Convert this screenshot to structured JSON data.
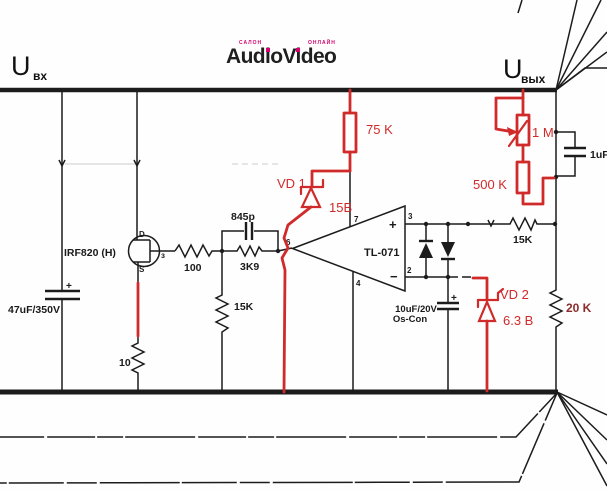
{
  "page": {
    "background": "#fefefe"
  },
  "colors": {
    "ink": "#1c1c1c",
    "annotation_red": "#d12a2a",
    "dark_red_label": "#8b2b2b",
    "logo_magenta": "#d6006e"
  },
  "header": {
    "input_label": {
      "base": "U",
      "sub": "вх"
    },
    "output_label": {
      "base": "U",
      "sub": "вых"
    },
    "logo": {
      "top_left": "салон",
      "main": "AudioVideo",
      "top_right": "онлайн"
    }
  },
  "components": {
    "input_cap": {
      "label": "47uF/350V",
      "plus": "+"
    },
    "mosfet": {
      "label": "IRF820 (H)",
      "pin_drain": "D",
      "pin_source": "S",
      "pin_gate": "з"
    },
    "gate_resistor": {
      "label": "100"
    },
    "feedback_cap": {
      "label": "845p"
    },
    "feedback_resistor": {
      "label": "3K9"
    },
    "gate_gnd_resistor": {
      "label": "15K"
    },
    "source_resistor": {
      "label": "10"
    },
    "opamp": {
      "label": "TL-071",
      "pin7": "7",
      "pin4": "4",
      "pin3": "3",
      "pin2": "2",
      "pin6": "6",
      "plus": "+",
      "minus": "−"
    },
    "supply_resistor": {
      "label": "75 K"
    },
    "zener1": {
      "designator": "VD 1",
      "value": "15B"
    },
    "pot": {
      "label": "1 M"
    },
    "divider_resistor": {
      "label": "500 K"
    },
    "output_cap": {
      "label": "1uF"
    },
    "sense_resistor": {
      "label": "15K"
    },
    "load_resistor": {
      "label": "20 K"
    },
    "oscon_cap": {
      "line1": "10uF/20V",
      "line2": "Os-Con",
      "plus": "+"
    },
    "zener2": {
      "designator": "VD 2",
      "value": "6.3 B"
    }
  }
}
